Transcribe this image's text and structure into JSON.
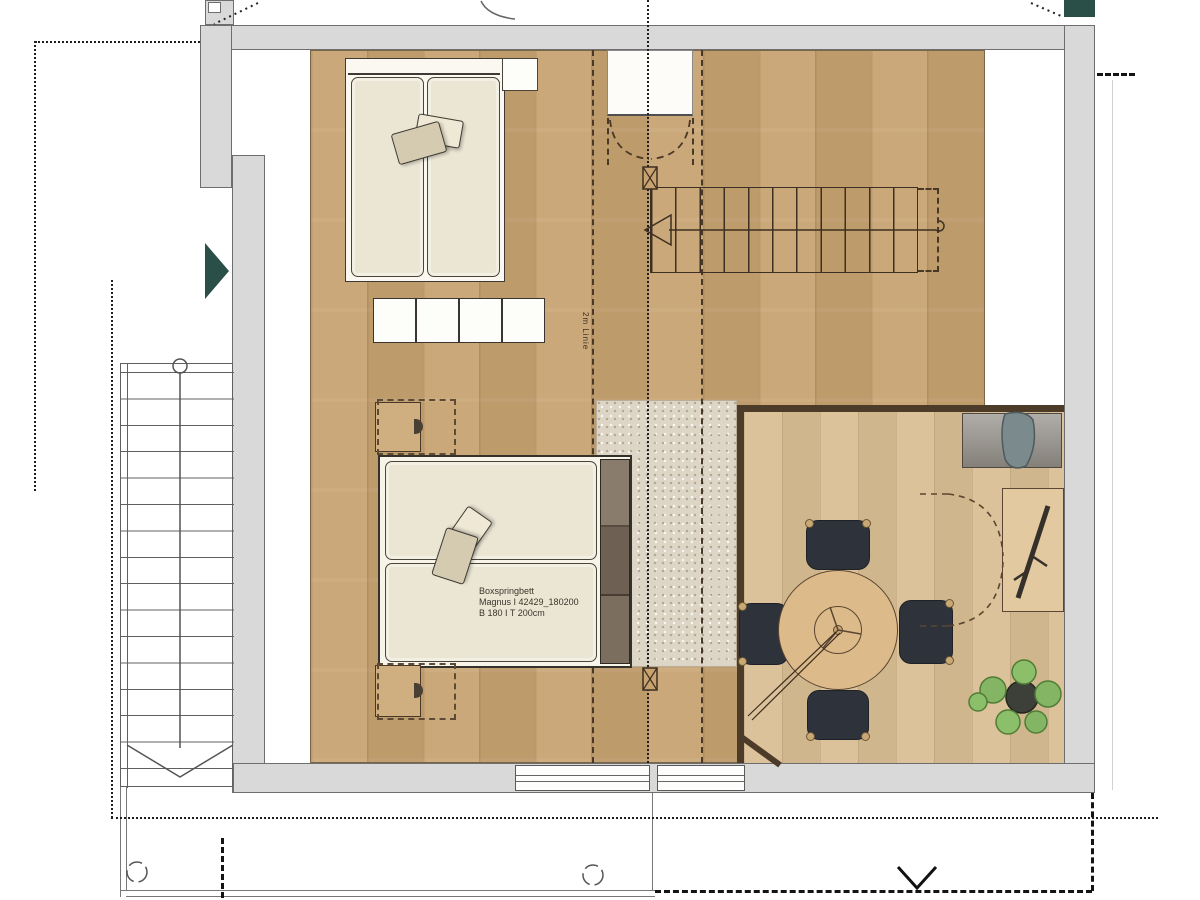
{
  "labels": {
    "bed_product_line1": "Boxspringbett",
    "bed_product_line2": "Magnus I 42429_180200",
    "bed_product_line3": "B 180 I T 200cm",
    "height_line": "2m Linie"
  },
  "colors": {
    "wall_fill": "#d9d9d9",
    "wall_edge": "#6e6e6e",
    "floor_main": "#c8a371",
    "floor_dining": "#d9bd92",
    "rug": "#ddd5c5",
    "interior_wall_brown": "#4d3b29",
    "mattress": "#ebe6d4",
    "bed_frame_white": "#faf8f0",
    "pillow_dark": "#d5cbb0",
    "pillow_light": "#eee8d5",
    "headboard": "#7b6e5f",
    "chair": "#2e323a",
    "table": "#dcba8a",
    "sideboard": "#96918a",
    "textile_on_sideboard": "#7b8a8d",
    "accent_teal": "#2a4f49",
    "plant_leaf": "#84b564",
    "plant_pot": "#3c4038",
    "nightstand_wood": "#cfae80"
  }
}
